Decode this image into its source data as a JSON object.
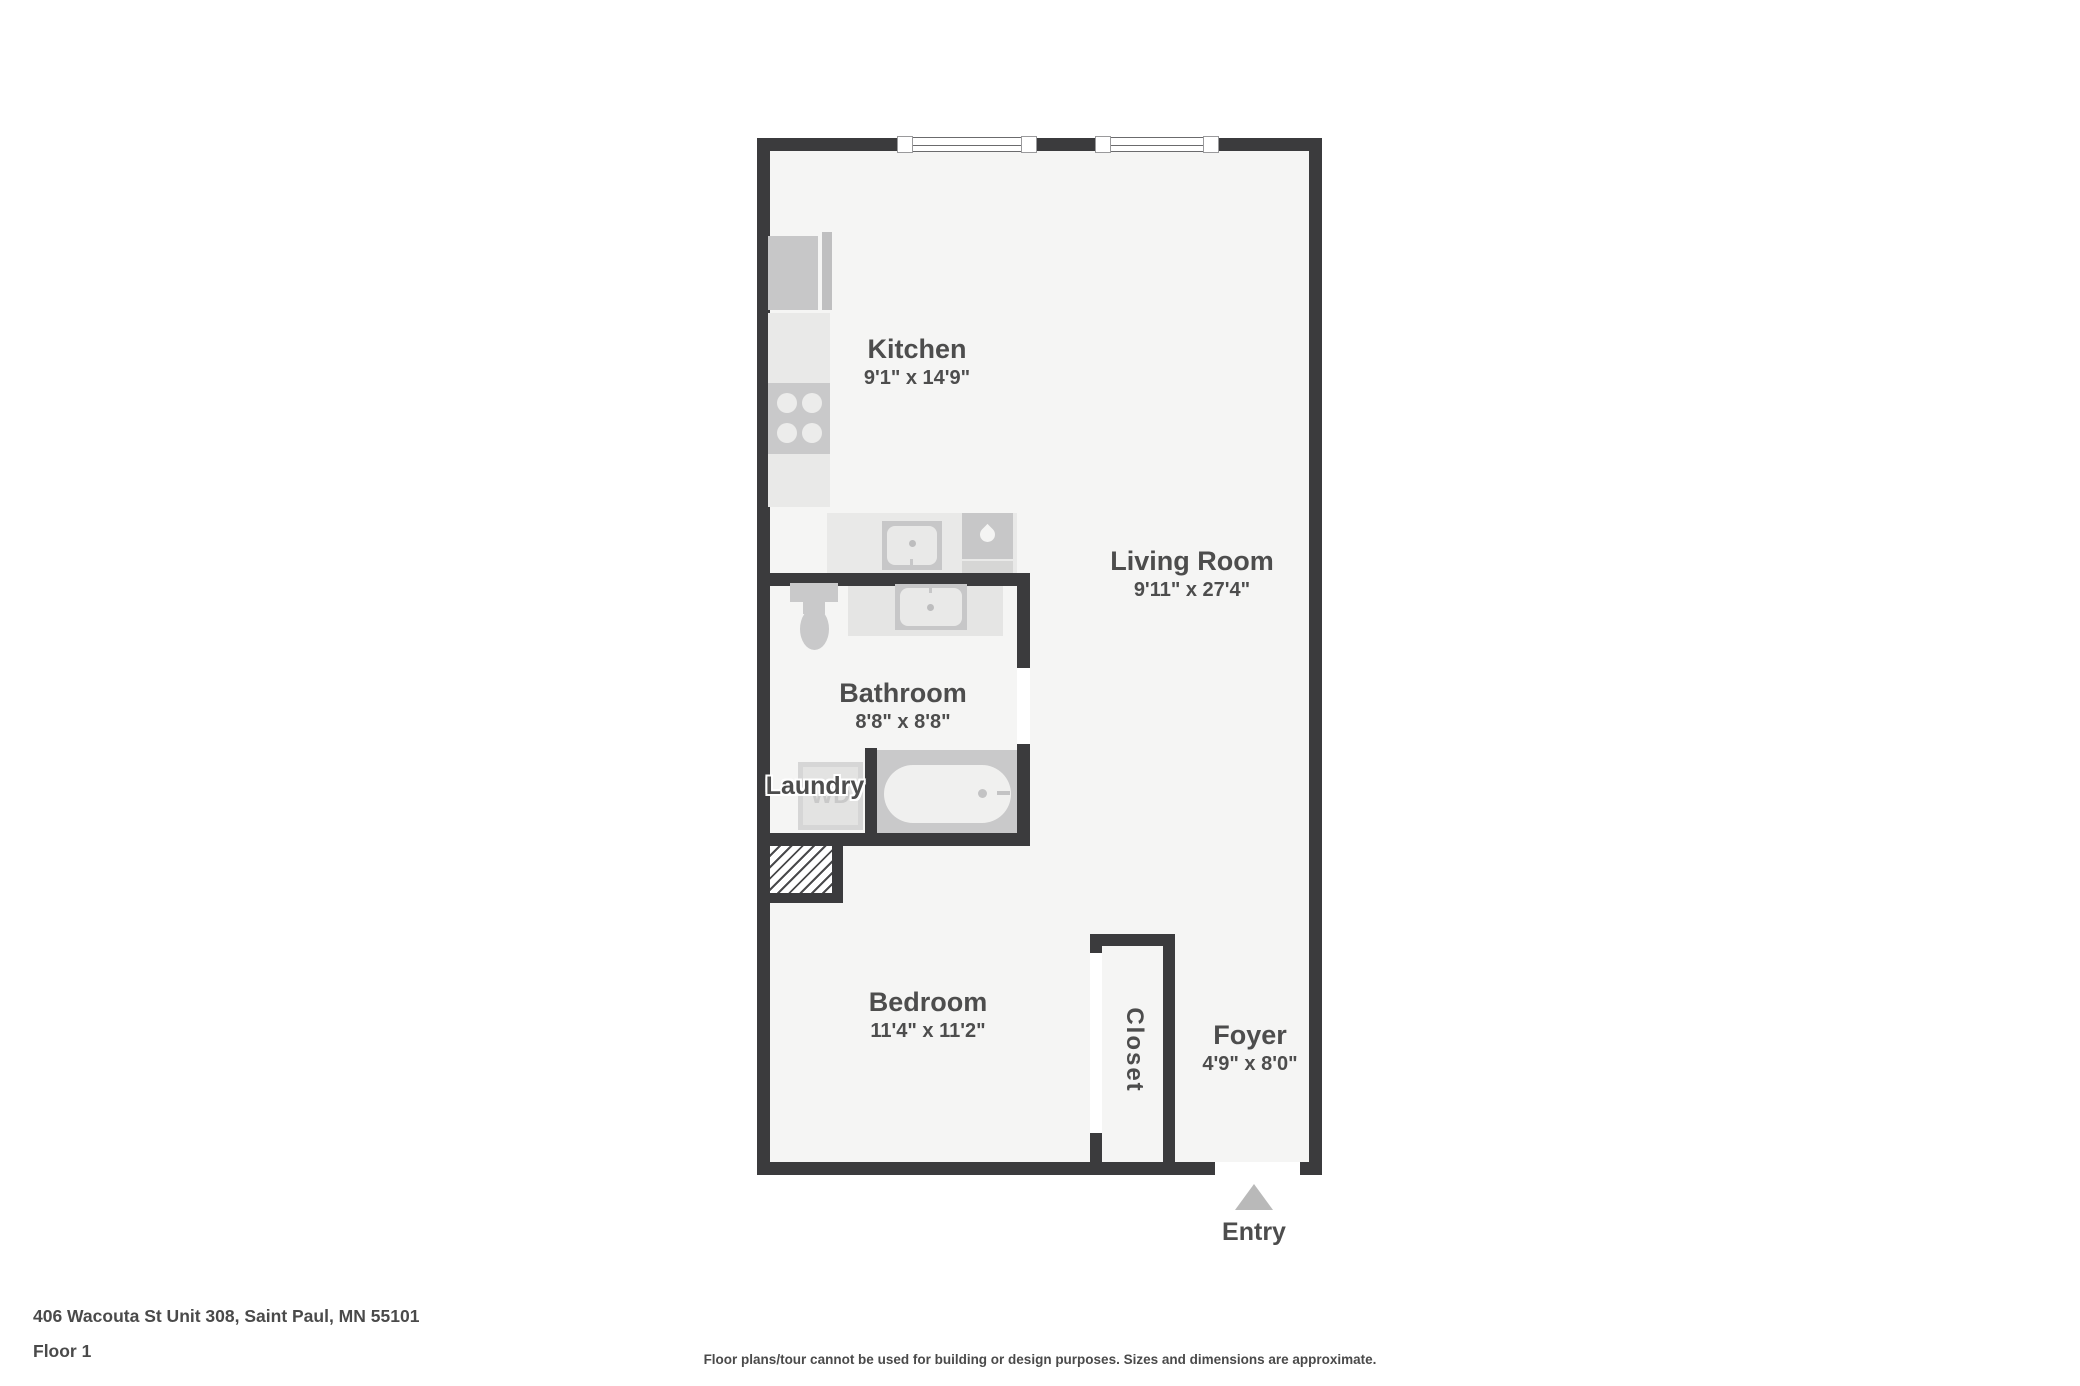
{
  "colors": {
    "wall": "#3b3b3d",
    "floor": "#f5f5f4",
    "fixLight": "#e9e9e8",
    "fixMid": "#c7c7c8",
    "label": "#4d4d4d",
    "arrow": "#b9b9b9"
  },
  "plan": {
    "rooms": {
      "kitchen": {
        "name": "Kitchen",
        "dims": "9'1\" x 14'9\""
      },
      "living_room": {
        "name": "Living Room",
        "dims": "9'11\" x 27'4\""
      },
      "bathroom": {
        "name": "Bathroom",
        "dims": "8'8\" x 8'8\""
      },
      "laundry": {
        "name": "Laundry"
      },
      "bedroom": {
        "name": "Bedroom",
        "dims": "11'4\" x 11'2\""
      },
      "closet": {
        "name": "Closet"
      },
      "foyer": {
        "name": "Foyer",
        "dims": "4'9\" x 8'0\""
      }
    },
    "entry": {
      "label": "Entry"
    },
    "washer": {
      "label": "WD"
    }
  },
  "footer": {
    "address": "406 Wacouta St Unit 308, Saint Paul, MN 55101",
    "floor_label": "Floor 1",
    "disclaimer": "Floor plans/tour cannot be used for building or design purposes. Sizes and dimensions are approximate."
  }
}
